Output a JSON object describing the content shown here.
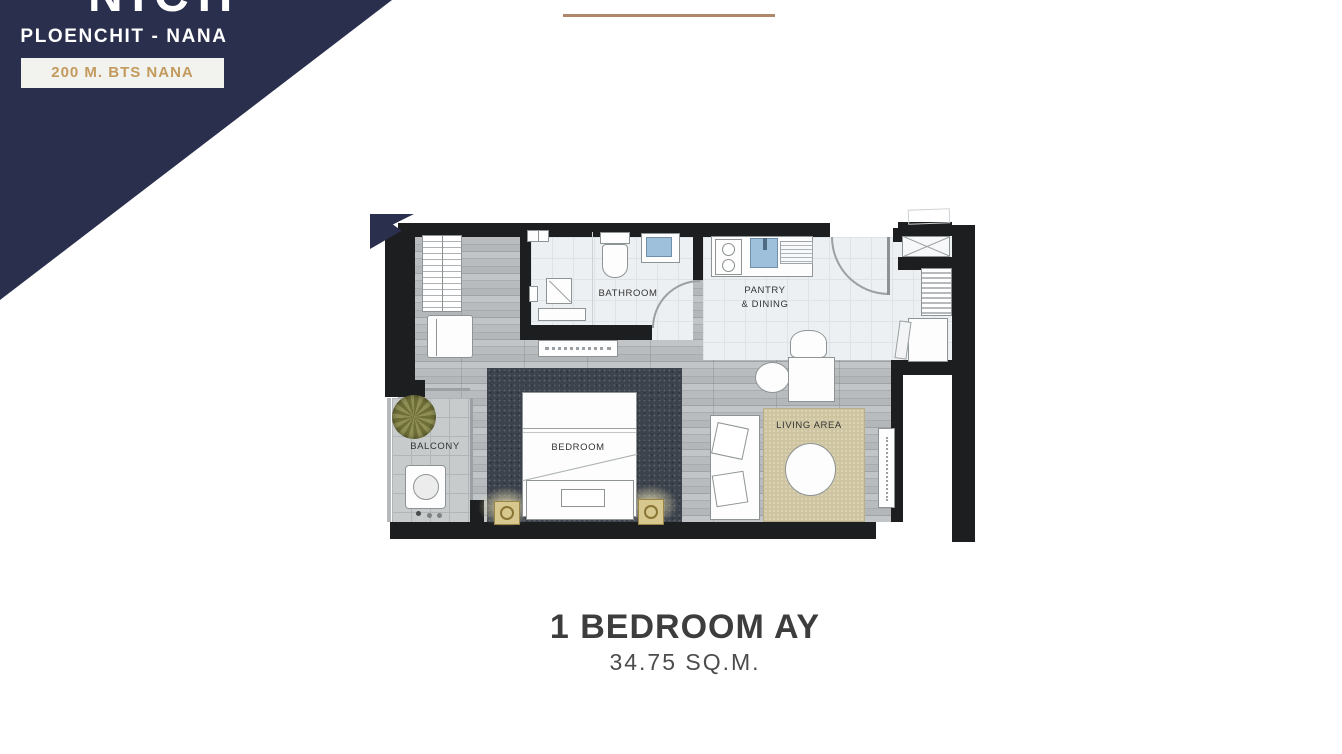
{
  "header": {
    "logo_fragment": "NICH",
    "project_name": "PLOENCHIT - NANA",
    "badge": "200 M. BTS NANA"
  },
  "plan": {
    "labels": {
      "bathroom": "BATHROOM",
      "pantry_line1": "PANTRY",
      "pantry_line2": "& DINING",
      "bedroom": "BEDROOM",
      "balcony": "BALCONY",
      "living_area": "LIVING AREA"
    }
  },
  "title": {
    "unit_name": "1 BEDROOM AY",
    "unit_area": "34.75 SQ.M."
  },
  "colors": {
    "navy": "#2a2f4d",
    "gold": "#c39a5d",
    "accentLine": "#b1876b",
    "wall": "#1d1e20",
    "bedroomRug": "#3d434d",
    "livingRug": "#cec49f",
    "fixtureBlue": "#9fc0da",
    "sconceGold": "#b89b4a"
  }
}
